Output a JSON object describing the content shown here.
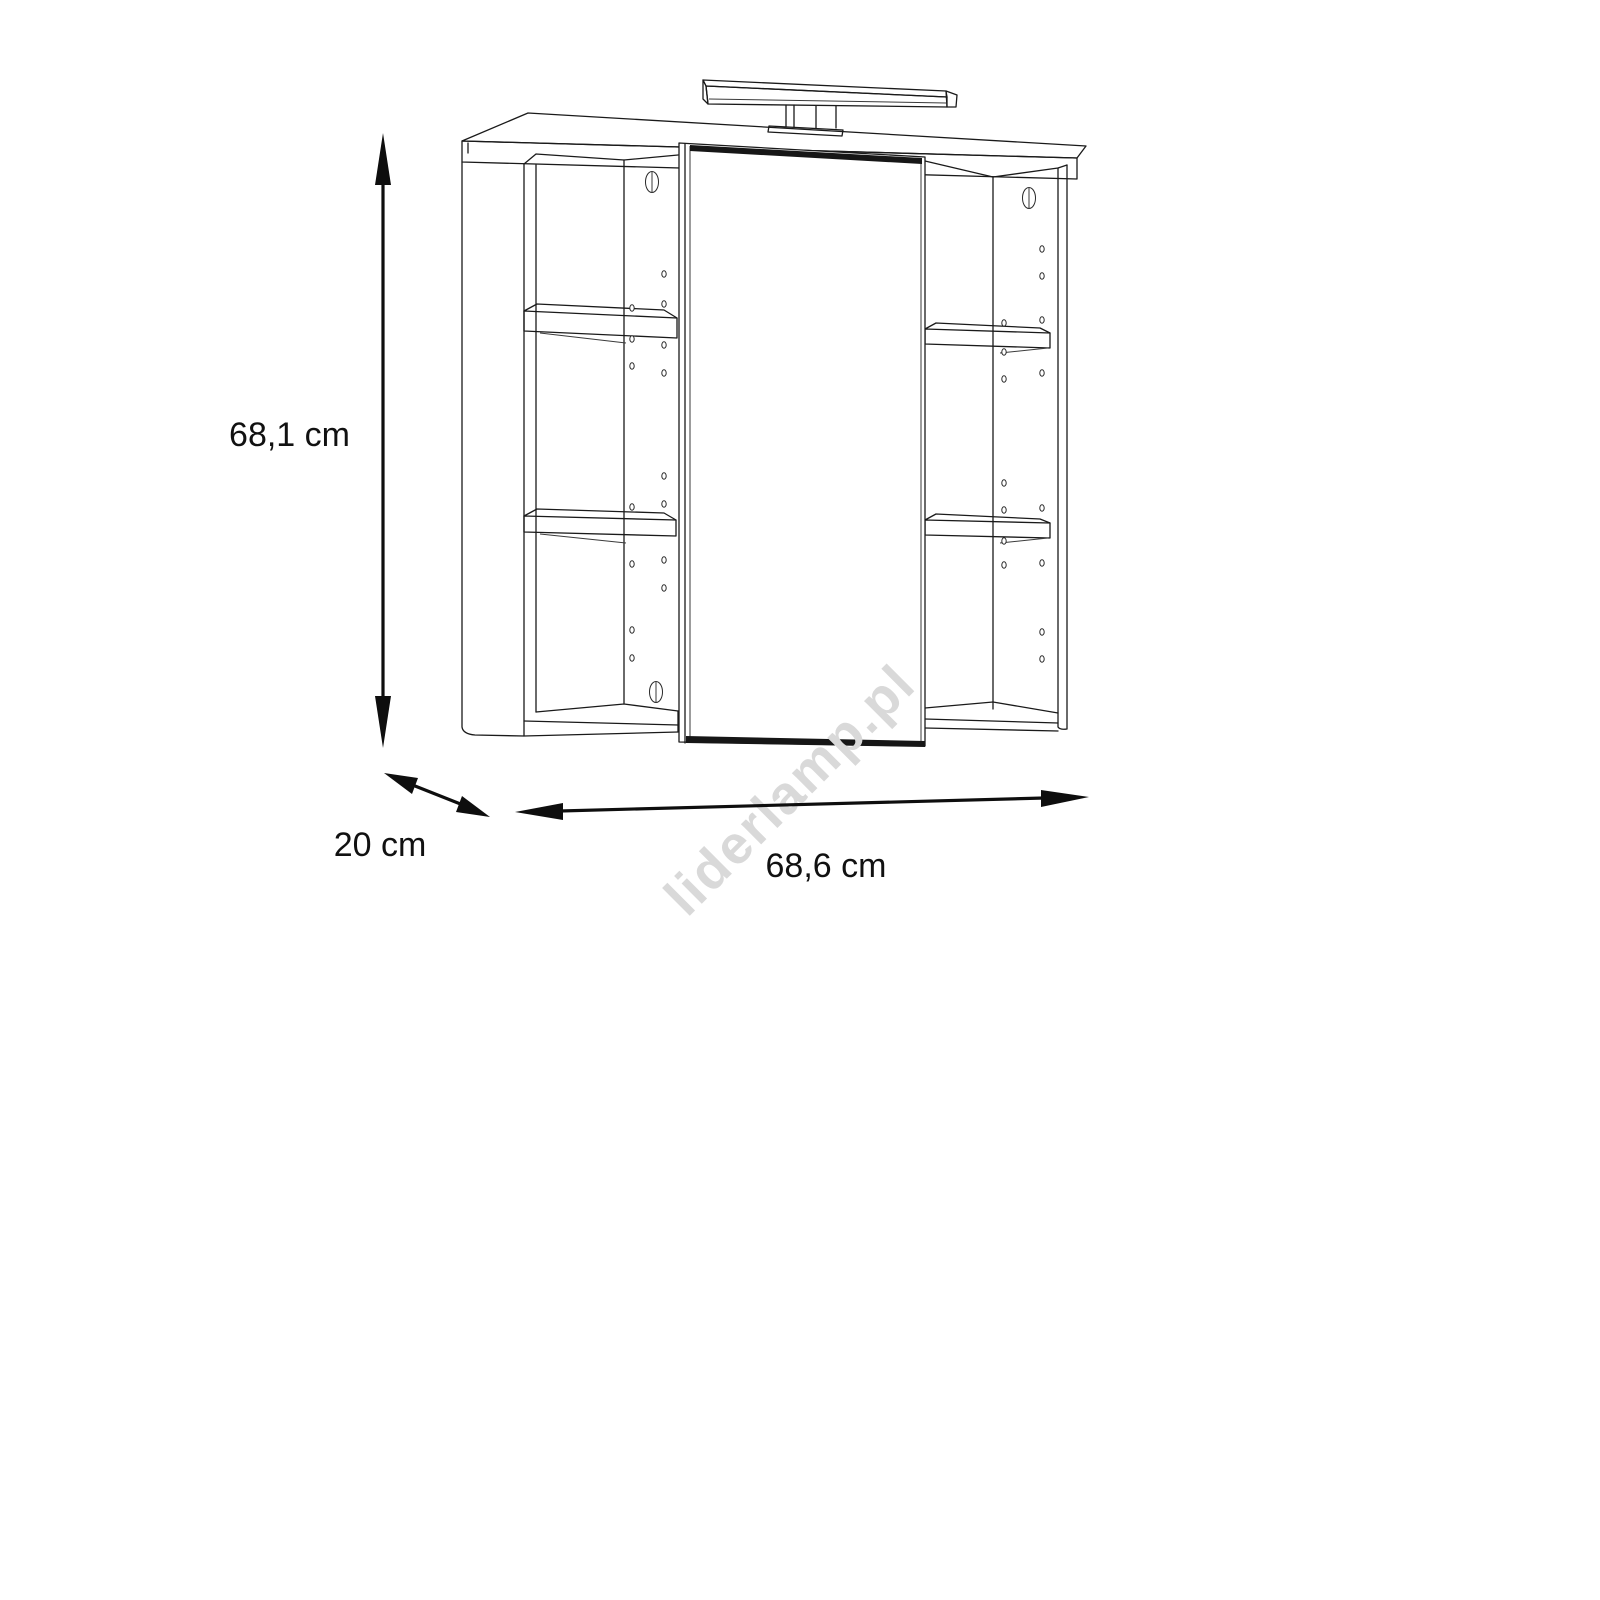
{
  "diagram": {
    "type": "furniture-dimension-drawing",
    "subject": "bathroom mirror cabinet with top light, two open side shelf columns and central mirror door",
    "dimensions": {
      "height": {
        "label": "68,1 cm",
        "value_cm": 68.1
      },
      "depth": {
        "label": "20 cm",
        "value_cm": 20
      },
      "width": {
        "label": "68,6 cm",
        "value_cm": 68.6
      }
    },
    "watermark": {
      "text": "liderlamp.pl",
      "color": "#d9d9d9"
    },
    "colors": {
      "line": "#1a1a1a",
      "background": "#ffffff",
      "door_edge": "#161616"
    }
  }
}
